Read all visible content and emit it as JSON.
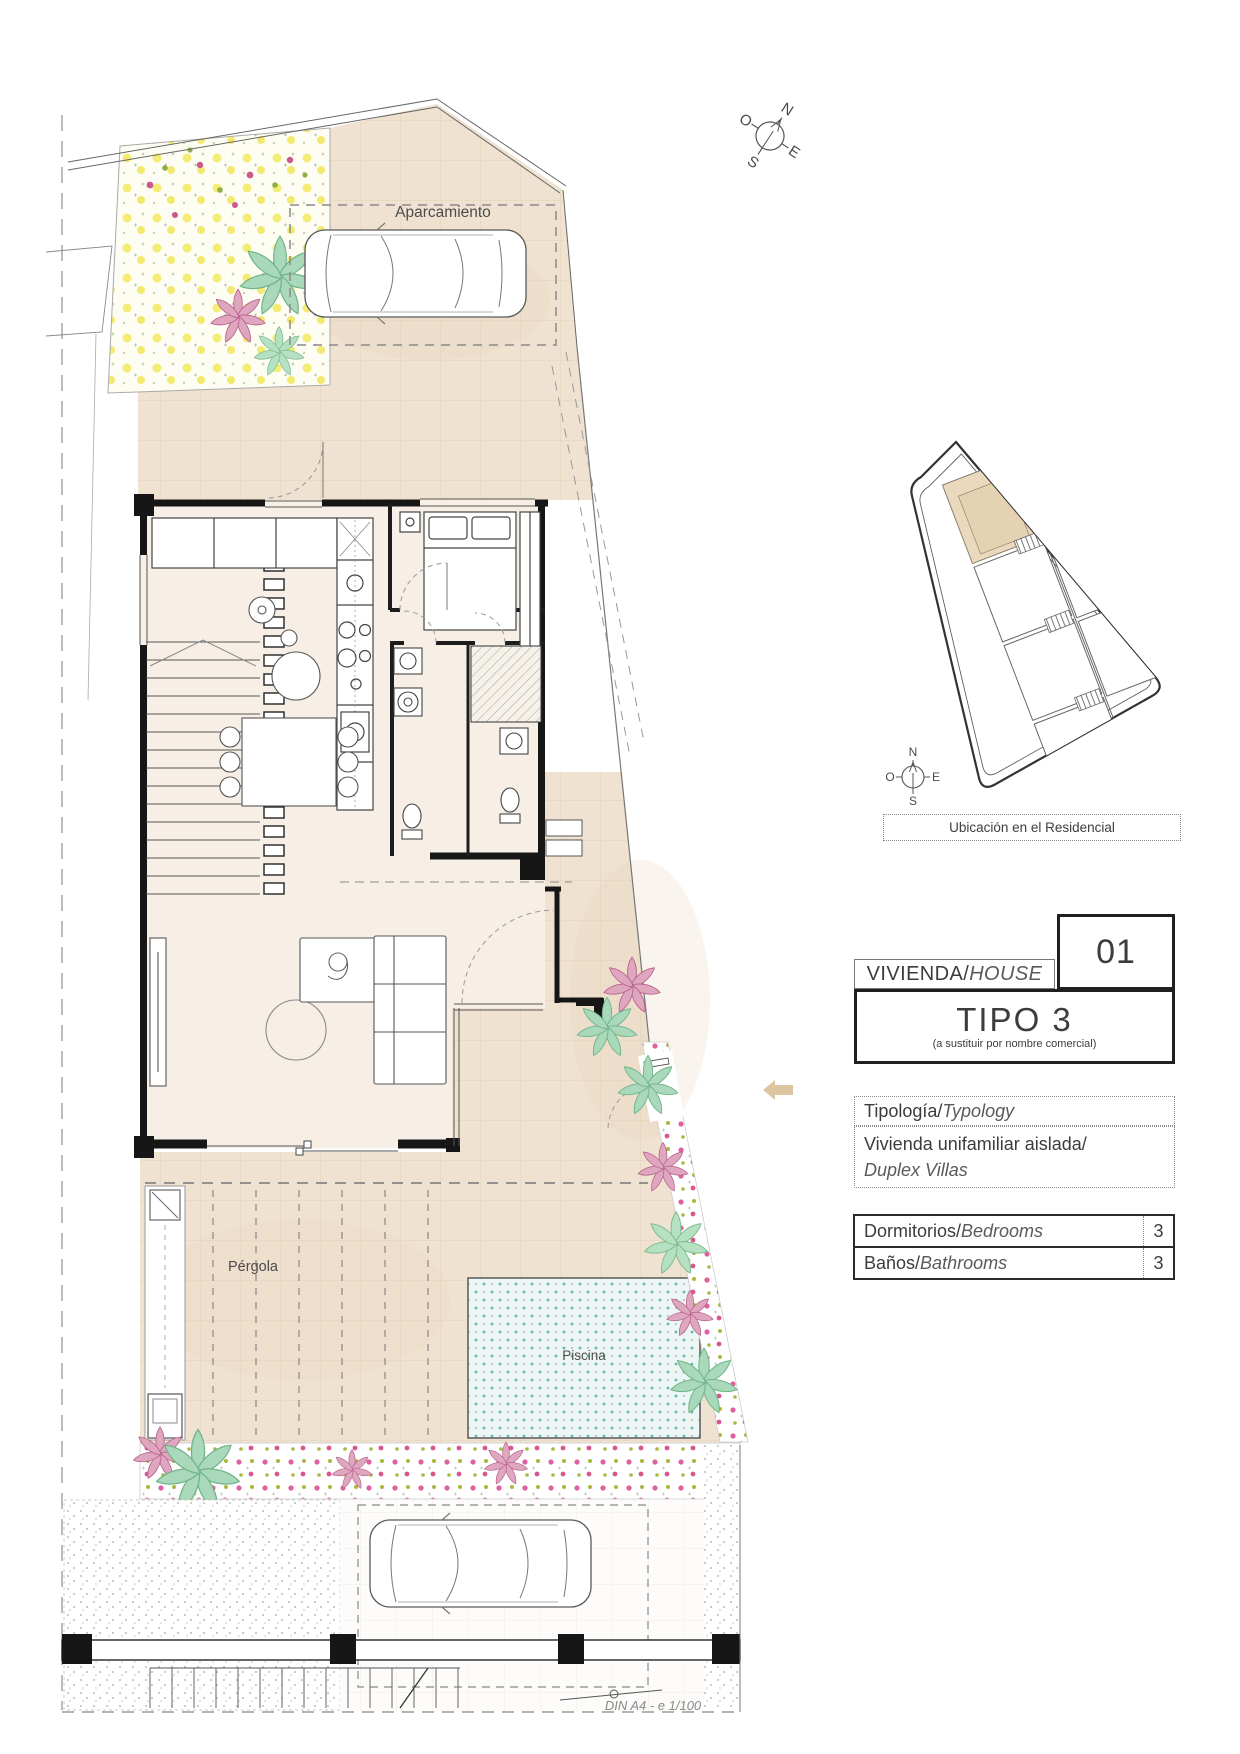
{
  "page": {
    "sheet_note": "DIN A4 - e 1/100"
  },
  "site_plan": {
    "parking_label": "Aparcamiento",
    "pergola_label": "Pérgola",
    "pool_label": "Piscina",
    "compass": {
      "n": "N",
      "s": "S",
      "e": "E",
      "o": "O"
    }
  },
  "location_plan": {
    "caption": "Ubicación en el Residencial",
    "compass": {
      "n": "N",
      "s": "S",
      "e": "E",
      "o": "O"
    }
  },
  "info_panel": {
    "unit_number": "01",
    "house_label_es": "VIVIENDA/",
    "house_label_en": "HOUSE",
    "type_title": "TIPO 3",
    "type_note": "(a sustituir por nombre comercial)",
    "typology_label_es": "Tipología/",
    "typology_label_en": "Typology",
    "typology_value_es": "Vivienda unifamiliar aislada/",
    "typology_value_en": "Duplex Villas",
    "rows": [
      {
        "label_es": "Dormitorios/",
        "label_en": "Bedrooms",
        "value": "3"
      },
      {
        "label_es": "Baños/",
        "label_en": "Bathrooms",
        "value": "3"
      }
    ],
    "colors": {
      "accent_tan": "#dcc5a0",
      "wall": "#1a1a1a",
      "paving_beige": "#efe2d0",
      "pool_blue": "#ecf7f5",
      "highlight_unit": "#ead9bd",
      "flower_pink": "#e0609f",
      "plant_green": "#7cc093"
    }
  }
}
